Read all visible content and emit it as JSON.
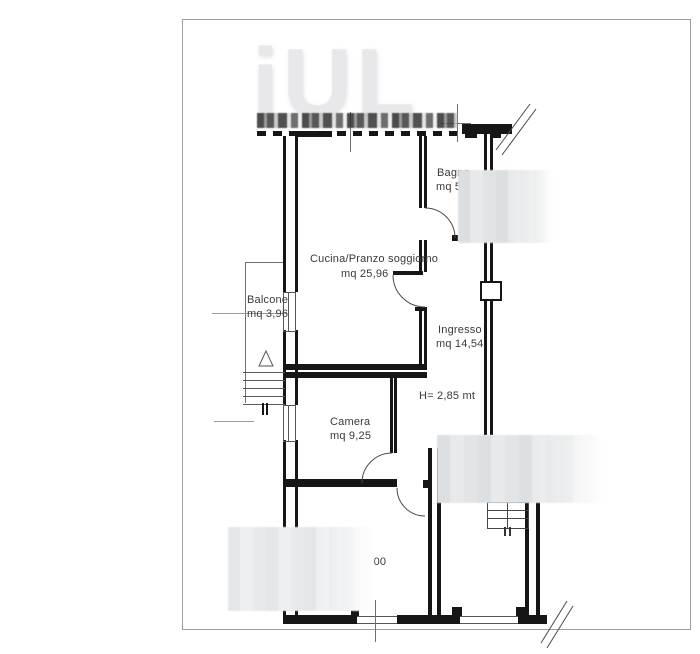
{
  "watermark": {
    "text": "iUL"
  },
  "rooms": [
    {
      "name": "Cucina/Pranzo soggiorno",
      "area": "mq 25,96"
    },
    {
      "name": "Balcone",
      "area": "mq 3,96"
    },
    {
      "name": "Camera",
      "area": "mq 9,25"
    },
    {
      "name": "Ingresso",
      "area": "mq 14,54"
    },
    {
      "name": "Bagno",
      "area": "mq 5"
    }
  ],
  "annotations": {
    "ceiling_height": "H= 2,85 mt",
    "width_dimension": "6,00"
  },
  "colors": {
    "wall": "#161616",
    "thin_line": "#6f6f6f",
    "label_text": "#3a3a3a",
    "frame_border": "#98a0a4",
    "watermark_text": "#e8e8eb",
    "redaction_fill": "#e2e5e7"
  }
}
